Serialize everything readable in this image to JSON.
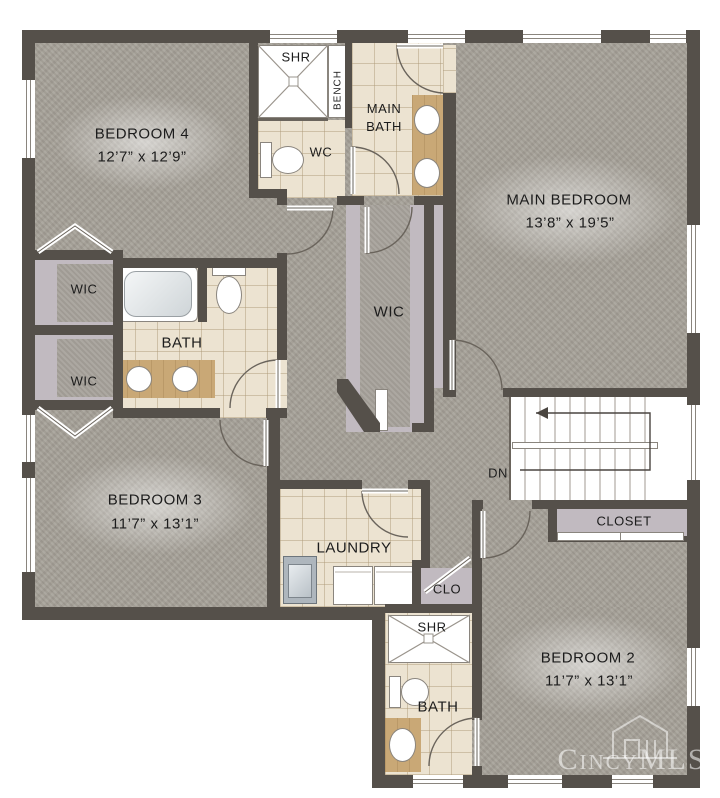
{
  "plan": {
    "type": "second-floor residential floor plan",
    "rooms": {
      "bedroom4": {
        "name": "BEDROOM 4",
        "dims": "12’7” x 12’9”"
      },
      "main_bedroom": {
        "name": "MAIN BEDROOM",
        "dims": "13’8” x 19’5”"
      },
      "bedroom3": {
        "name": "BEDROOM 3",
        "dims": "11’7” x 13’1”"
      },
      "bedroom2": {
        "name": "BEDROOM 2",
        "dims": "11’7” x 13’1”"
      },
      "main_bath": {
        "name": "MAIN BATH"
      },
      "hall_bath": {
        "name": "BATH"
      },
      "ensuite_bath": {
        "name": "BATH"
      },
      "laundry": {
        "name": "LAUNDRY"
      },
      "wic_main": {
        "name": "WIC"
      },
      "wic_left_upper": {
        "name": "WIC"
      },
      "wic_left_lower": {
        "name": "WIC"
      },
      "closet_bedroom2": {
        "name": "CLOSET"
      },
      "clo_hall": {
        "name": "CLO"
      },
      "shower_main": {
        "name": "SHR"
      },
      "shower_ensuite": {
        "name": "SHR"
      },
      "bench": {
        "name": "BENCH"
      },
      "wc": {
        "name": "WC"
      },
      "stairs": {
        "down_label": "DN"
      }
    },
    "watermark": {
      "text": "CincyMLS"
    },
    "colors": {
      "wall": "#55504a",
      "carpet": "#a6a198",
      "tile": "#ece3d1",
      "closet_floor": "#c1bac0",
      "counter": "#c9a876",
      "background": "#ffffff"
    }
  }
}
